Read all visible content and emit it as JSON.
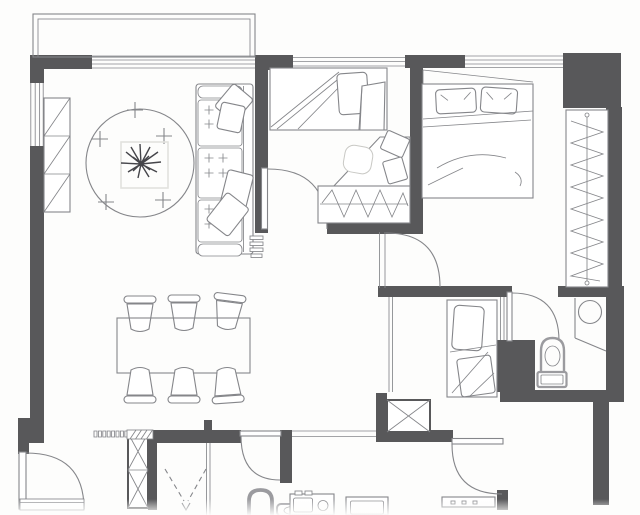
{
  "document": {
    "kind": "residential apartment floor plan",
    "view": "top-down 2D architectural drawing, monochrome scan",
    "visible_text": []
  },
  "palette": {
    "paper": "#fdfdfc",
    "wall": "#58585a",
    "line": "#85868a",
    "light_line": "#c9c9c5",
    "faint_line": "#e2e2de",
    "fixture_line": "#9b9b9f",
    "ink": "#45454a"
  },
  "rooms": [
    {
      "name": "balcony",
      "location": "top-left outside main wall",
      "contents": [
        "double-line railing"
      ]
    },
    {
      "name": "living-room",
      "location": "upper-left",
      "contents": [
        "round area rug with plus marks",
        "square coffee table",
        "potted plant",
        "three-seat tufted sofa with throw pillows",
        "tall bookshelf on west wall",
        "slatted floor vent"
      ]
    },
    {
      "name": "dining-area",
      "location": "lower-left",
      "contents": [
        "rectangular dining table",
        "six chairs, three per long side"
      ]
    },
    {
      "name": "study-bedroom",
      "location": "top-center",
      "contents": [
        "single bed with pillow and folded blanket",
        "corner desk with chamfered edge",
        "desk chair",
        "two seat cushions",
        "built-in wardrobe with hanging-rod zigzag symbol"
      ]
    },
    {
      "name": "master-bedroom",
      "location": "top-right",
      "contents": [
        "double bed with two pillows",
        "angled headboard panel",
        "full-height wardrobe with rod and hanger zigzag on east side"
      ]
    },
    {
      "name": "small-bedroom",
      "location": "center-right",
      "contents": [
        "single bed with pillow and blanket",
        "thin glass partition on west side"
      ]
    },
    {
      "name": "ensuite-bathroom",
      "location": "right",
      "contents": [
        "toilet with tank",
        "round basin on counter",
        "angled counter edge"
      ]
    },
    {
      "name": "common-bathroom",
      "location": "bottom-center",
      "contents": [
        "shower area marked with dashed V",
        "arched toilet symbol",
        "low rounded fixture"
      ]
    },
    {
      "name": "kitchen",
      "location": "bottom",
      "contents": [
        "cooktop-oven unit",
        "double-line sink",
        "counter strip with burner dots",
        "pass-through double line"
      ]
    },
    {
      "name": "entry-foyer",
      "location": "bottom-left",
      "contents": [
        "entrance door with quarter-circle swing",
        "threshold strip"
      ]
    },
    {
      "name": "service-shaft-west",
      "location": "bottom-left wall",
      "contents": [
        "double X duct symbol",
        "vent grille of small squares",
        "hatched patch"
      ]
    },
    {
      "name": "service-shaft-east",
      "location": "below small bedroom",
      "contents": [
        "single X duct symbol"
      ]
    }
  ],
  "openings": {
    "windows": [
      {
        "id": "living-window",
        "wall": "north",
        "size": "wide"
      },
      {
        "id": "study-window",
        "wall": "north",
        "size": "medium"
      },
      {
        "id": "master-window",
        "wall": "north",
        "size": "medium"
      },
      {
        "id": "living-side-window",
        "wall": "west",
        "size": "medium"
      }
    ],
    "doors": [
      {
        "id": "entrance-door",
        "room": "entry-foyer",
        "swing": "quarter arc inward"
      },
      {
        "id": "study-door",
        "room": "study-bedroom",
        "swing": "quarter arc into room"
      },
      {
        "id": "master-door",
        "room": "master-bedroom",
        "swing": "quarter arc into room"
      },
      {
        "id": "ensuite-door",
        "room": "ensuite-bathroom",
        "swing": "quarter arc into room"
      },
      {
        "id": "bathroom-door",
        "room": "common-bathroom",
        "swing": "quarter arc into room"
      },
      {
        "id": "kitchen-door",
        "room": "kitchen",
        "swing": "quarter arc into room"
      }
    ]
  }
}
